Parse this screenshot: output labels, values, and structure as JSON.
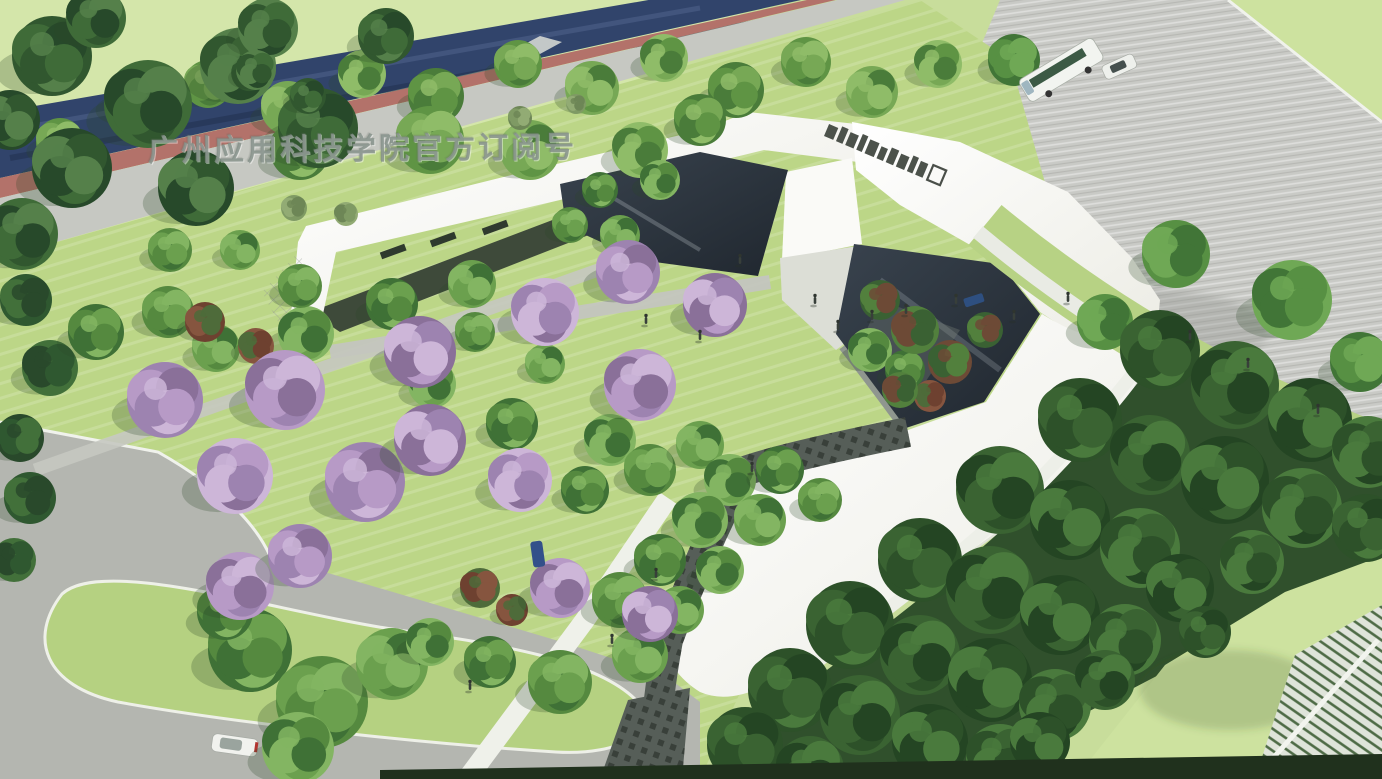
{
  "meta": {
    "kind": "architectural-aerial-rendering",
    "subject": "campus entrance gateway with landscaped gardens"
  },
  "watermark": {
    "text": "广州应用科技学院官方订阅号"
  },
  "palette": {
    "paper": "#eef0e9",
    "grass_base": "#c8dd9b",
    "grass_light": "#d4e6aa",
    "grass_site": "#bcd687",
    "grass_blob": "#b5d181",
    "grass_corner": "#cde29f",
    "road_navy": "#31446b",
    "bike_red": "#b3726a",
    "sidewalk": "#c6c8c2",
    "plaza": "#c9cac6",
    "road_gray": "#b4b6b0",
    "roof_white": "#fafaf7",
    "glass_dark": "#2e3742",
    "walk_dark": "#565e58",
    "pergola": "#3e4a3a",
    "forest_base": "#30502c",
    "hedge": "#20311d",
    "curb": "#f0f2ec",
    "watermark_color": "rgba(133,145,138,0.85)"
  },
  "roof_sign": {
    "name": "roof-sign-sculpture",
    "block_widths": [
      10,
      7,
      9,
      6,
      10,
      7,
      8,
      9,
      6,
      8
    ],
    "outlined_end_block": true
  },
  "vehicles": {
    "bus": {
      "name": "shuttle-bus",
      "body": "#f2f4f0",
      "windows": "#3c5a45"
    },
    "car_plaza": {
      "name": "white-car",
      "body": "#eef0ec"
    },
    "car_road": {
      "name": "white-car-bottom",
      "body": "#f1f2ee",
      "tail": "#b23530"
    },
    "car_courtyard": {
      "name": "blue-car-courtyard",
      "body": "#2e4f80"
    },
    "car_path": {
      "name": "blue-car-path",
      "body": "#33508a"
    }
  },
  "people": {
    "items": [
      [
        740,
        262
      ],
      [
        646,
        322
      ],
      [
        700,
        338
      ],
      [
        815,
        302
      ],
      [
        838,
        328
      ],
      [
        872,
        318
      ],
      [
        906,
        312
      ],
      [
        956,
        302
      ],
      [
        1014,
        318
      ],
      [
        1068,
        300
      ],
      [
        1190,
        338
      ],
      [
        1248,
        366
      ],
      [
        1318,
        412
      ],
      [
        656,
        576
      ],
      [
        612,
        642
      ],
      [
        752,
        470
      ],
      [
        470,
        688
      ]
    ]
  },
  "vegetation": {
    "street_trees": {
      "palette": [
        "#4a7c3a",
        "#5f9444",
        "#77a855",
        "#8fbc68"
      ],
      "shadow": true,
      "items": [
        [
          132,
          100,
          26
        ],
        [
          208,
          84,
          24
        ],
        [
          288,
          108,
          27
        ],
        [
          362,
          74,
          24
        ],
        [
          436,
          96,
          28
        ],
        [
          518,
          64,
          24
        ],
        [
          592,
          88,
          27
        ],
        [
          664,
          58,
          24
        ],
        [
          736,
          90,
          28
        ],
        [
          806,
          62,
          25
        ],
        [
          872,
          92,
          26
        ],
        [
          938,
          64,
          24
        ],
        [
          300,
          150,
          30
        ],
        [
          430,
          140,
          34
        ],
        [
          530,
          150,
          30
        ],
        [
          640,
          150,
          28
        ],
        [
          700,
          120,
          26
        ],
        [
          60,
          142,
          24
        ]
      ]
    },
    "corner_trees": {
      "palette": [
        "#31572f",
        "#3f6b38",
        "#27492a",
        "#55804a"
      ],
      "shadow": true,
      "items": [
        [
          52,
          56,
          40
        ],
        [
          148,
          104,
          44
        ],
        [
          72,
          168,
          40
        ],
        [
          238,
          66,
          38
        ],
        [
          318,
          128,
          40
        ],
        [
          22,
          234,
          36
        ],
        [
          196,
          188,
          38
        ],
        [
          268,
          28,
          30
        ],
        [
          386,
          36,
          28
        ],
        [
          96,
          18,
          30
        ],
        [
          10,
          120,
          30
        ],
        [
          256,
          70,
          20
        ],
        [
          308,
          96,
          18
        ]
      ]
    },
    "left_edge_trees": {
      "palette": [
        "#2f5830",
        "#42703a",
        "#29492b"
      ],
      "shadow": true,
      "items": [
        [
          26,
          300,
          26
        ],
        [
          50,
          368,
          28
        ],
        [
          20,
          438,
          24
        ],
        [
          30,
          498,
          26
        ],
        [
          14,
          560,
          22
        ]
      ]
    },
    "lawn_bushes": {
      "palette": [
        "#7f9a64",
        "#92ab74",
        "#6d8656"
      ],
      "shadow": false,
      "items": [
        [
          294,
          208,
          13
        ],
        [
          346,
          214,
          12
        ],
        [
          520,
          118,
          12
        ],
        [
          576,
          104,
          10
        ]
      ]
    },
    "site_green": {
      "palette": [
        "#3f7136",
        "#55893f",
        "#6ba04e",
        "#83b562"
      ],
      "shadow": true,
      "items": [
        [
          96,
          332,
          28
        ],
        [
          168,
          312,
          26
        ],
        [
          216,
          348,
          24
        ],
        [
          306,
          334,
          28
        ],
        [
          392,
          304,
          26
        ],
        [
          300,
          286,
          22
        ],
        [
          472,
          284,
          24
        ],
        [
          432,
          384,
          24
        ],
        [
          512,
          424,
          26
        ],
        [
          475,
          332,
          20
        ],
        [
          545,
          364,
          20
        ],
        [
          610,
          440,
          26
        ],
        [
          585,
          490,
          24
        ],
        [
          650,
          470,
          26
        ],
        [
          700,
          445,
          24
        ],
        [
          730,
          480,
          26
        ],
        [
          780,
          470,
          24
        ],
        [
          820,
          500,
          22
        ],
        [
          760,
          520,
          26
        ],
        [
          700,
          520,
          28
        ],
        [
          660,
          560,
          26
        ],
        [
          620,
          600,
          28
        ],
        [
          680,
          610,
          24
        ],
        [
          720,
          570,
          24
        ],
        [
          250,
          650,
          42
        ],
        [
          322,
          702,
          46
        ],
        [
          392,
          664,
          36
        ],
        [
          298,
          748,
          36
        ],
        [
          225,
          612,
          28
        ],
        [
          560,
          682,
          32
        ],
        [
          640,
          655,
          28
        ],
        [
          430,
          642,
          24
        ],
        [
          490,
          662,
          26
        ],
        [
          170,
          250,
          22
        ],
        [
          240,
          250,
          20
        ],
        [
          660,
          180,
          20
        ],
        [
          600,
          190,
          18
        ],
        [
          570,
          225,
          18
        ],
        [
          620,
          235,
          20
        ],
        [
          870,
          350,
          22
        ],
        [
          905,
          370,
          20
        ]
      ]
    },
    "red_bushes": {
      "palette": [
        "#6e4130",
        "#86553f",
        "#4e6b3a"
      ],
      "shadow": true,
      "items": [
        [
          205,
          322,
          20
        ],
        [
          256,
          346,
          18
        ],
        [
          480,
          588,
          20
        ],
        [
          512,
          610,
          16
        ],
        [
          930,
          396,
          16
        ]
      ]
    },
    "purple_trees": {
      "palette": [
        "#9d83b0",
        "#b79ac6",
        "#8a7099",
        "#cdb6d8"
      ],
      "shadow": true,
      "items": [
        [
          165,
          400,
          38
        ],
        [
          285,
          390,
          40
        ],
        [
          420,
          352,
          36
        ],
        [
          545,
          312,
          34
        ],
        [
          628,
          272,
          32
        ],
        [
          640,
          385,
          36
        ],
        [
          715,
          305,
          32
        ],
        [
          235,
          476,
          38
        ],
        [
          365,
          482,
          40
        ],
        [
          240,
          586,
          34
        ],
        [
          430,
          440,
          36
        ],
        [
          520,
          480,
          32
        ],
        [
          300,
          556,
          32
        ],
        [
          560,
          588,
          30
        ],
        [
          650,
          614,
          28
        ]
      ]
    },
    "courtyard_trees": {
      "palette": [
        "#3a6133",
        "#52803d",
        "#6d4a36"
      ],
      "shadow": false,
      "items": [
        [
          880,
          300,
          20
        ],
        [
          915,
          330,
          24
        ],
        [
          950,
          362,
          22
        ],
        [
          985,
          330,
          18
        ],
        [
          900,
          390,
          18
        ]
      ]
    },
    "plaza_trees": {
      "palette": [
        "#417537",
        "#579043",
        "#6fa855"
      ],
      "shadow": true,
      "items": [
        [
          1014,
          60,
          26
        ],
        [
          1176,
          254,
          34
        ],
        [
          1292,
          300,
          40
        ],
        [
          1360,
          362,
          30
        ],
        [
          1105,
          322,
          28
        ]
      ]
    },
    "forest_trees": {
      "palette": [
        "#2d5129",
        "#3a6332",
        "#244523",
        "#4a7a3d"
      ],
      "shadow": false,
      "items": [
        [
          1160,
          350,
          40
        ],
        [
          1235,
          385,
          44
        ],
        [
          1310,
          420,
          42
        ],
        [
          1368,
          452,
          36
        ],
        [
          1080,
          420,
          42
        ],
        [
          1150,
          455,
          40
        ],
        [
          1225,
          480,
          44
        ],
        [
          1302,
          508,
          40
        ],
        [
          1366,
          528,
          34
        ],
        [
          1000,
          490,
          44
        ],
        [
          1070,
          520,
          40
        ],
        [
          1140,
          548,
          40
        ],
        [
          920,
          560,
          42
        ],
        [
          990,
          590,
          44
        ],
        [
          1060,
          615,
          40
        ],
        [
          1125,
          640,
          36
        ],
        [
          850,
          625,
          44
        ],
        [
          920,
          655,
          40
        ],
        [
          990,
          680,
          42
        ],
        [
          1055,
          705,
          36
        ],
        [
          790,
          690,
          42
        ],
        [
          860,
          715,
          40
        ],
        [
          930,
          742,
          38
        ],
        [
          1000,
          758,
          34
        ],
        [
          745,
          745,
          38
        ],
        [
          810,
          770,
          34
        ],
        [
          1180,
          588,
          34
        ],
        [
          1252,
          562,
          32
        ],
        [
          1205,
          632,
          26
        ],
        [
          1105,
          680,
          30
        ],
        [
          1040,
          742,
          30
        ]
      ]
    }
  }
}
